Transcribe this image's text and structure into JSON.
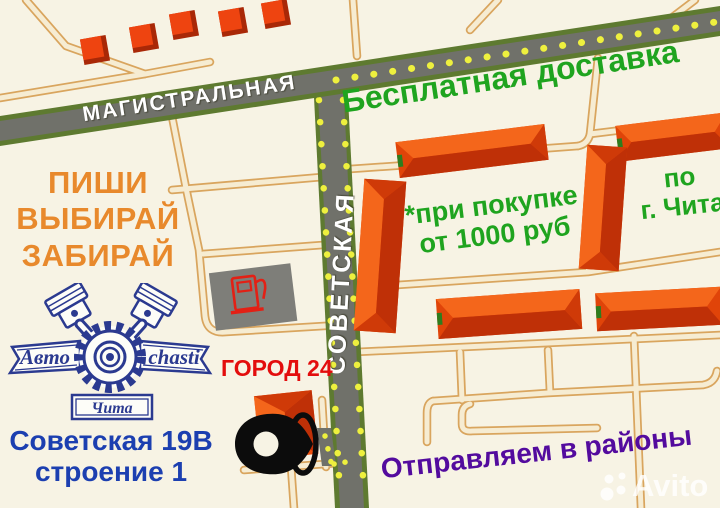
{
  "promo": {
    "slogan_line1": "ПИШИ",
    "slogan_line2": "ВЫБИРАЙ",
    "slogan_line3": "ЗАБИРАЙ",
    "free_delivery": "Бесплатная доставка",
    "purchase_condition_line1": "*при покупке",
    "purchase_condition_line2": "от 1000 руб",
    "delivery_city_line1": "по",
    "delivery_city_line2": "г. Чита",
    "ship_regions": "Отправляем в районы"
  },
  "map": {
    "street_magistralnaya": "МАГИСТРАЛЬНАЯ",
    "street_sovetskaya": "СОВЕТСКАЯ",
    "landmark": "ГОРОД 24"
  },
  "store": {
    "logo_name_left": "Авто",
    "logo_name_right": "chasti",
    "logo_city": "Чита",
    "address_line1": "Советская 19В",
    "address_line2": "строение 1"
  },
  "watermark": {
    "text": "Avito"
  },
  "colors": {
    "background": "#f7f3e4",
    "road_gray": "#70716a",
    "road_edge_green": "#5e7a30",
    "dash_yellow": "#eef03e",
    "minor_road_fill": "#f6ecd2",
    "minor_road_border": "#d9a55e",
    "building_orange": "#ee5110",
    "building_dark": "#bf3007",
    "text_green": "#1fa41f",
    "text_orange": "#e8892c",
    "text_red": "#e30d0d",
    "text_blue": "#1c3fb0",
    "text_purple": "#530b9e",
    "logo_navy": "#2b3a90",
    "pin_black": "#0c0c0c",
    "gas_gray": "#7e7e79",
    "gas_pump_red": "#e32015"
  }
}
